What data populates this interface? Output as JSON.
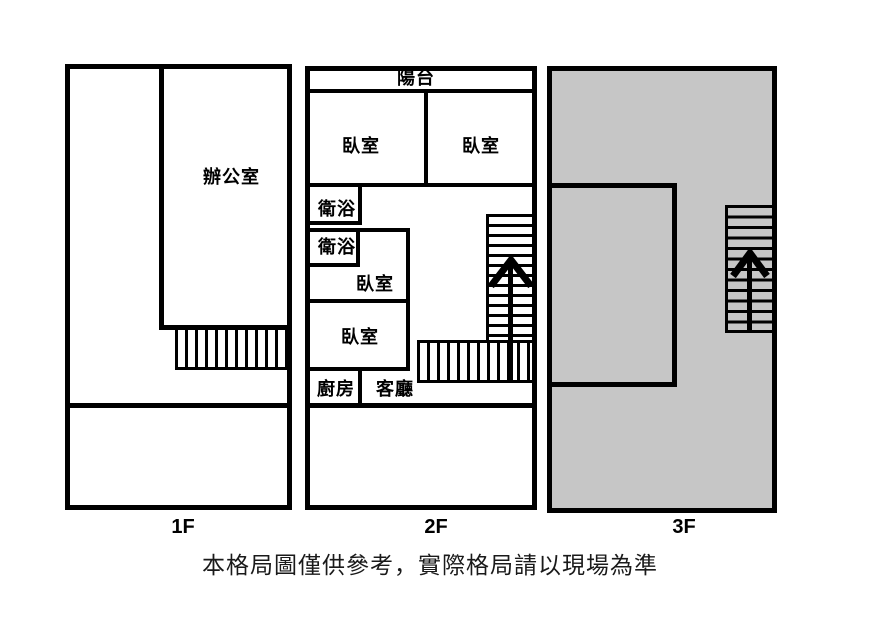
{
  "floor_labels": {
    "floor1": "1F",
    "floor2": "2F",
    "floor3": "3F"
  },
  "rooms": {
    "office": "辦公室",
    "balcony": "陽台",
    "bedroom_top_left": "臥室",
    "bedroom_top_right": "臥室",
    "bath_upper": "衛浴",
    "bath_lower": "衛浴",
    "bedroom_mid": "臥室",
    "bedroom_lower": "臥室",
    "kitchen": "廚房",
    "living_room": "客廳"
  },
  "disclaimer": "本格局圖僅供參考，實際格局請以現場為準",
  "icons": {
    "stairs_up_arrow_2f": "up-arrow",
    "stairs_up_arrow_3f": "up-arrow"
  },
  "colors": {
    "wall": "#000000",
    "floor3_fill": "#c6c6c6",
    "background": "#ffffff",
    "text": "#000000",
    "disclaimer_text": "#1a1a1a"
  }
}
